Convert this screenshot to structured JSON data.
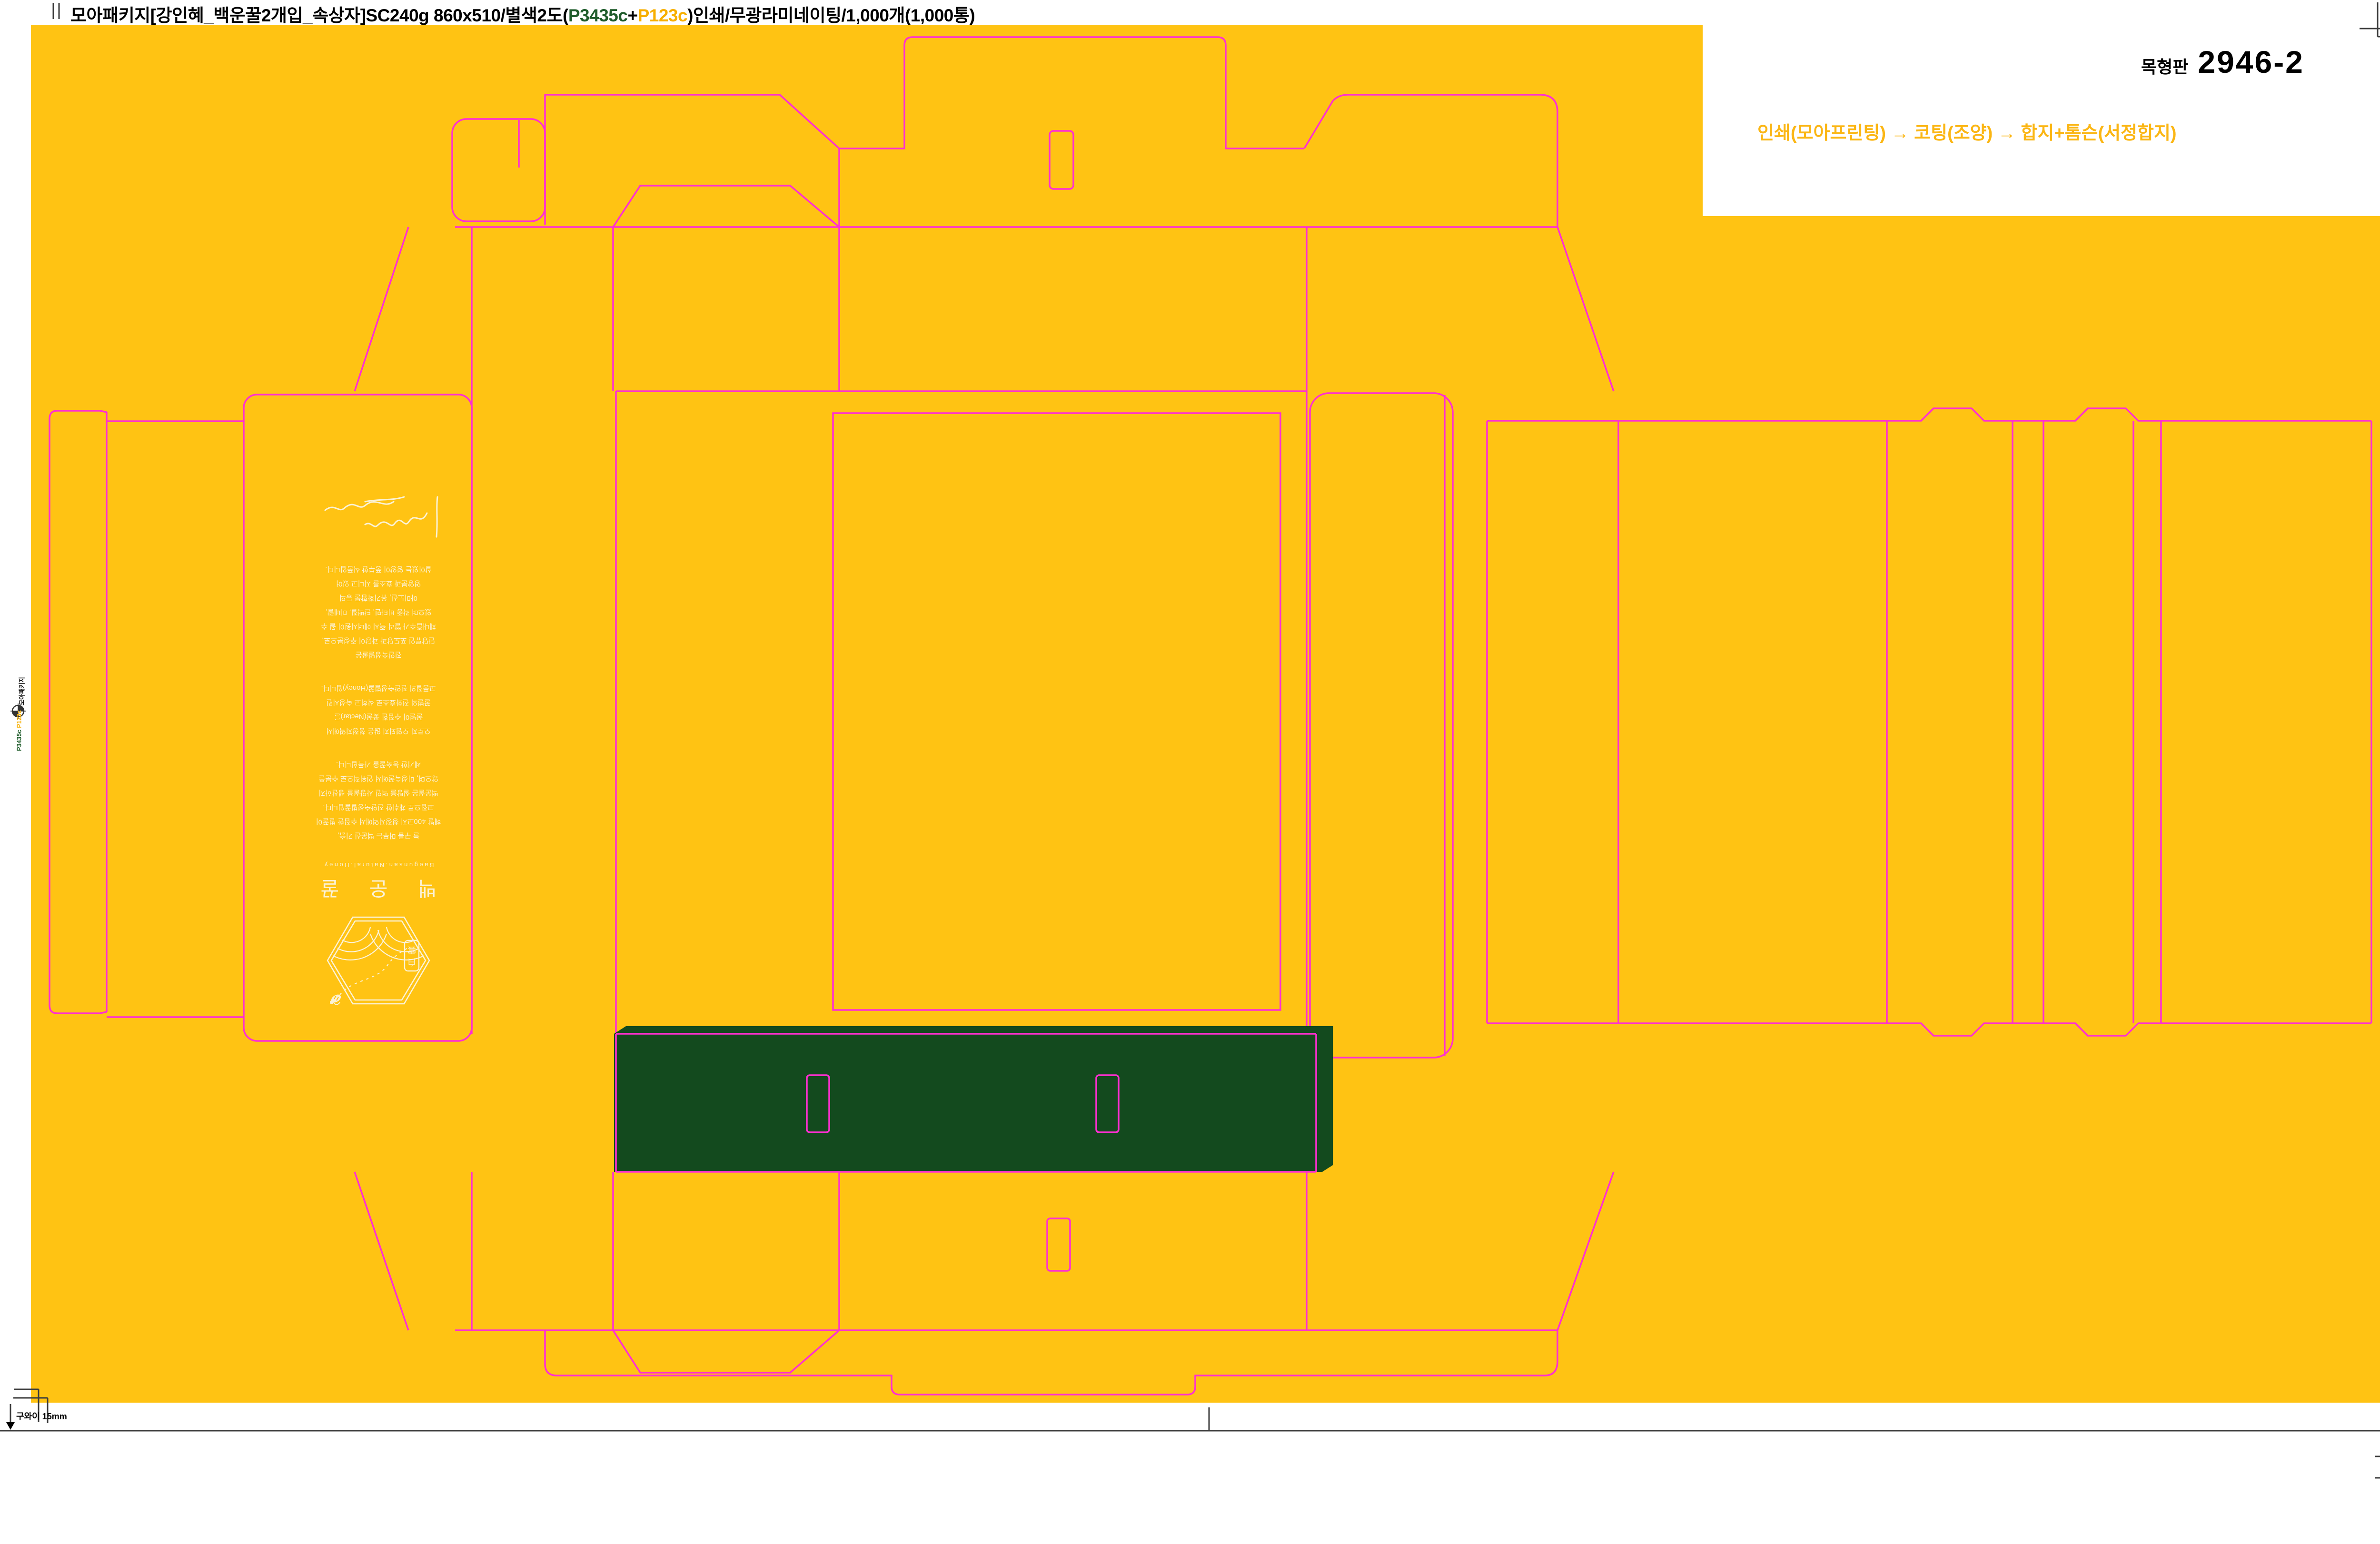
{
  "header": {
    "title_prefix": "모아패키지[강인혜_백운꿀2개입_속상자]SC240g 860x510/별색2도(",
    "spot1": "P3435c",
    "plus": "+",
    "spot2": "P123c",
    "title_suffix": ")인쇄/무광라미네이팅/1,000개(1,000통)"
  },
  "plate": {
    "label": "목형판",
    "number": "2946-2"
  },
  "workflow": {
    "text": "인쇄(모아프린팅) → 코팅(조양) →  합지+톰슨(서정합지)"
  },
  "margins": {
    "left_label": "모아패키지",
    "right_label": "모아패키지",
    "spot1": "P3435c",
    "spot2": "P123c"
  },
  "gripper": {
    "note": "구와이 15mm"
  },
  "panel": {
    "brand_kr": "백 운 꿀",
    "brand_en": "Baegunsan.Natural.Honey",
    "seal_char1": "白",
    "seal_char2": "雲",
    "paragraph1": [
      "늘 구름 머무는 백운산 기슭,",
      "해발 400고지 청정지역에서 수집한 벌꿀이",
      "고집으로 채취한 진안숙성벌꿀입니다.",
      "백운꿀은 설탕을 먹인 사양꿀을 생산하지",
      "않으며, 미성숙꿀에서 인위적으로 수분을",
      "제거한 농축꿀을 가득합니다."
    ],
    "paragraph2": [
      "오로지 오염되지 않은 청정지역에서",
      "꿀벌이 수집한 꽃꿀(Nectar)를",
      "꿀벌의 전화효소로 삭히고 숙성시킨",
      "고품질의 진안숙성벌꿀(Honey)입니다."
    ],
    "paragraph3": [
      "진안숙성벌꿀은",
      "단당류인 포도당과 과당이 주성분으로,",
      "체내흡수가 빨라 즉시 에너지원이 될 수",
      "있으며 각종 비타민, 단백질, 미네랄,",
      "아미노산, 유기화합물 등의",
      "영양분과 효소를 지니고 있어",
      "살아있는 영양이 풍부한 식품입니다."
    ]
  },
  "colors": {
    "sheet_yellow": "#FFC313",
    "dieline_magenta": "#FF2FD2",
    "band_green": "#134A1E",
    "cream": "#FBF2D6",
    "plate_green": "#1E5B2A",
    "plate_yellow": "#F7AF00",
    "workflow_yellow": "#FBB614",
    "mark_gray": "#3C3C3C"
  }
}
